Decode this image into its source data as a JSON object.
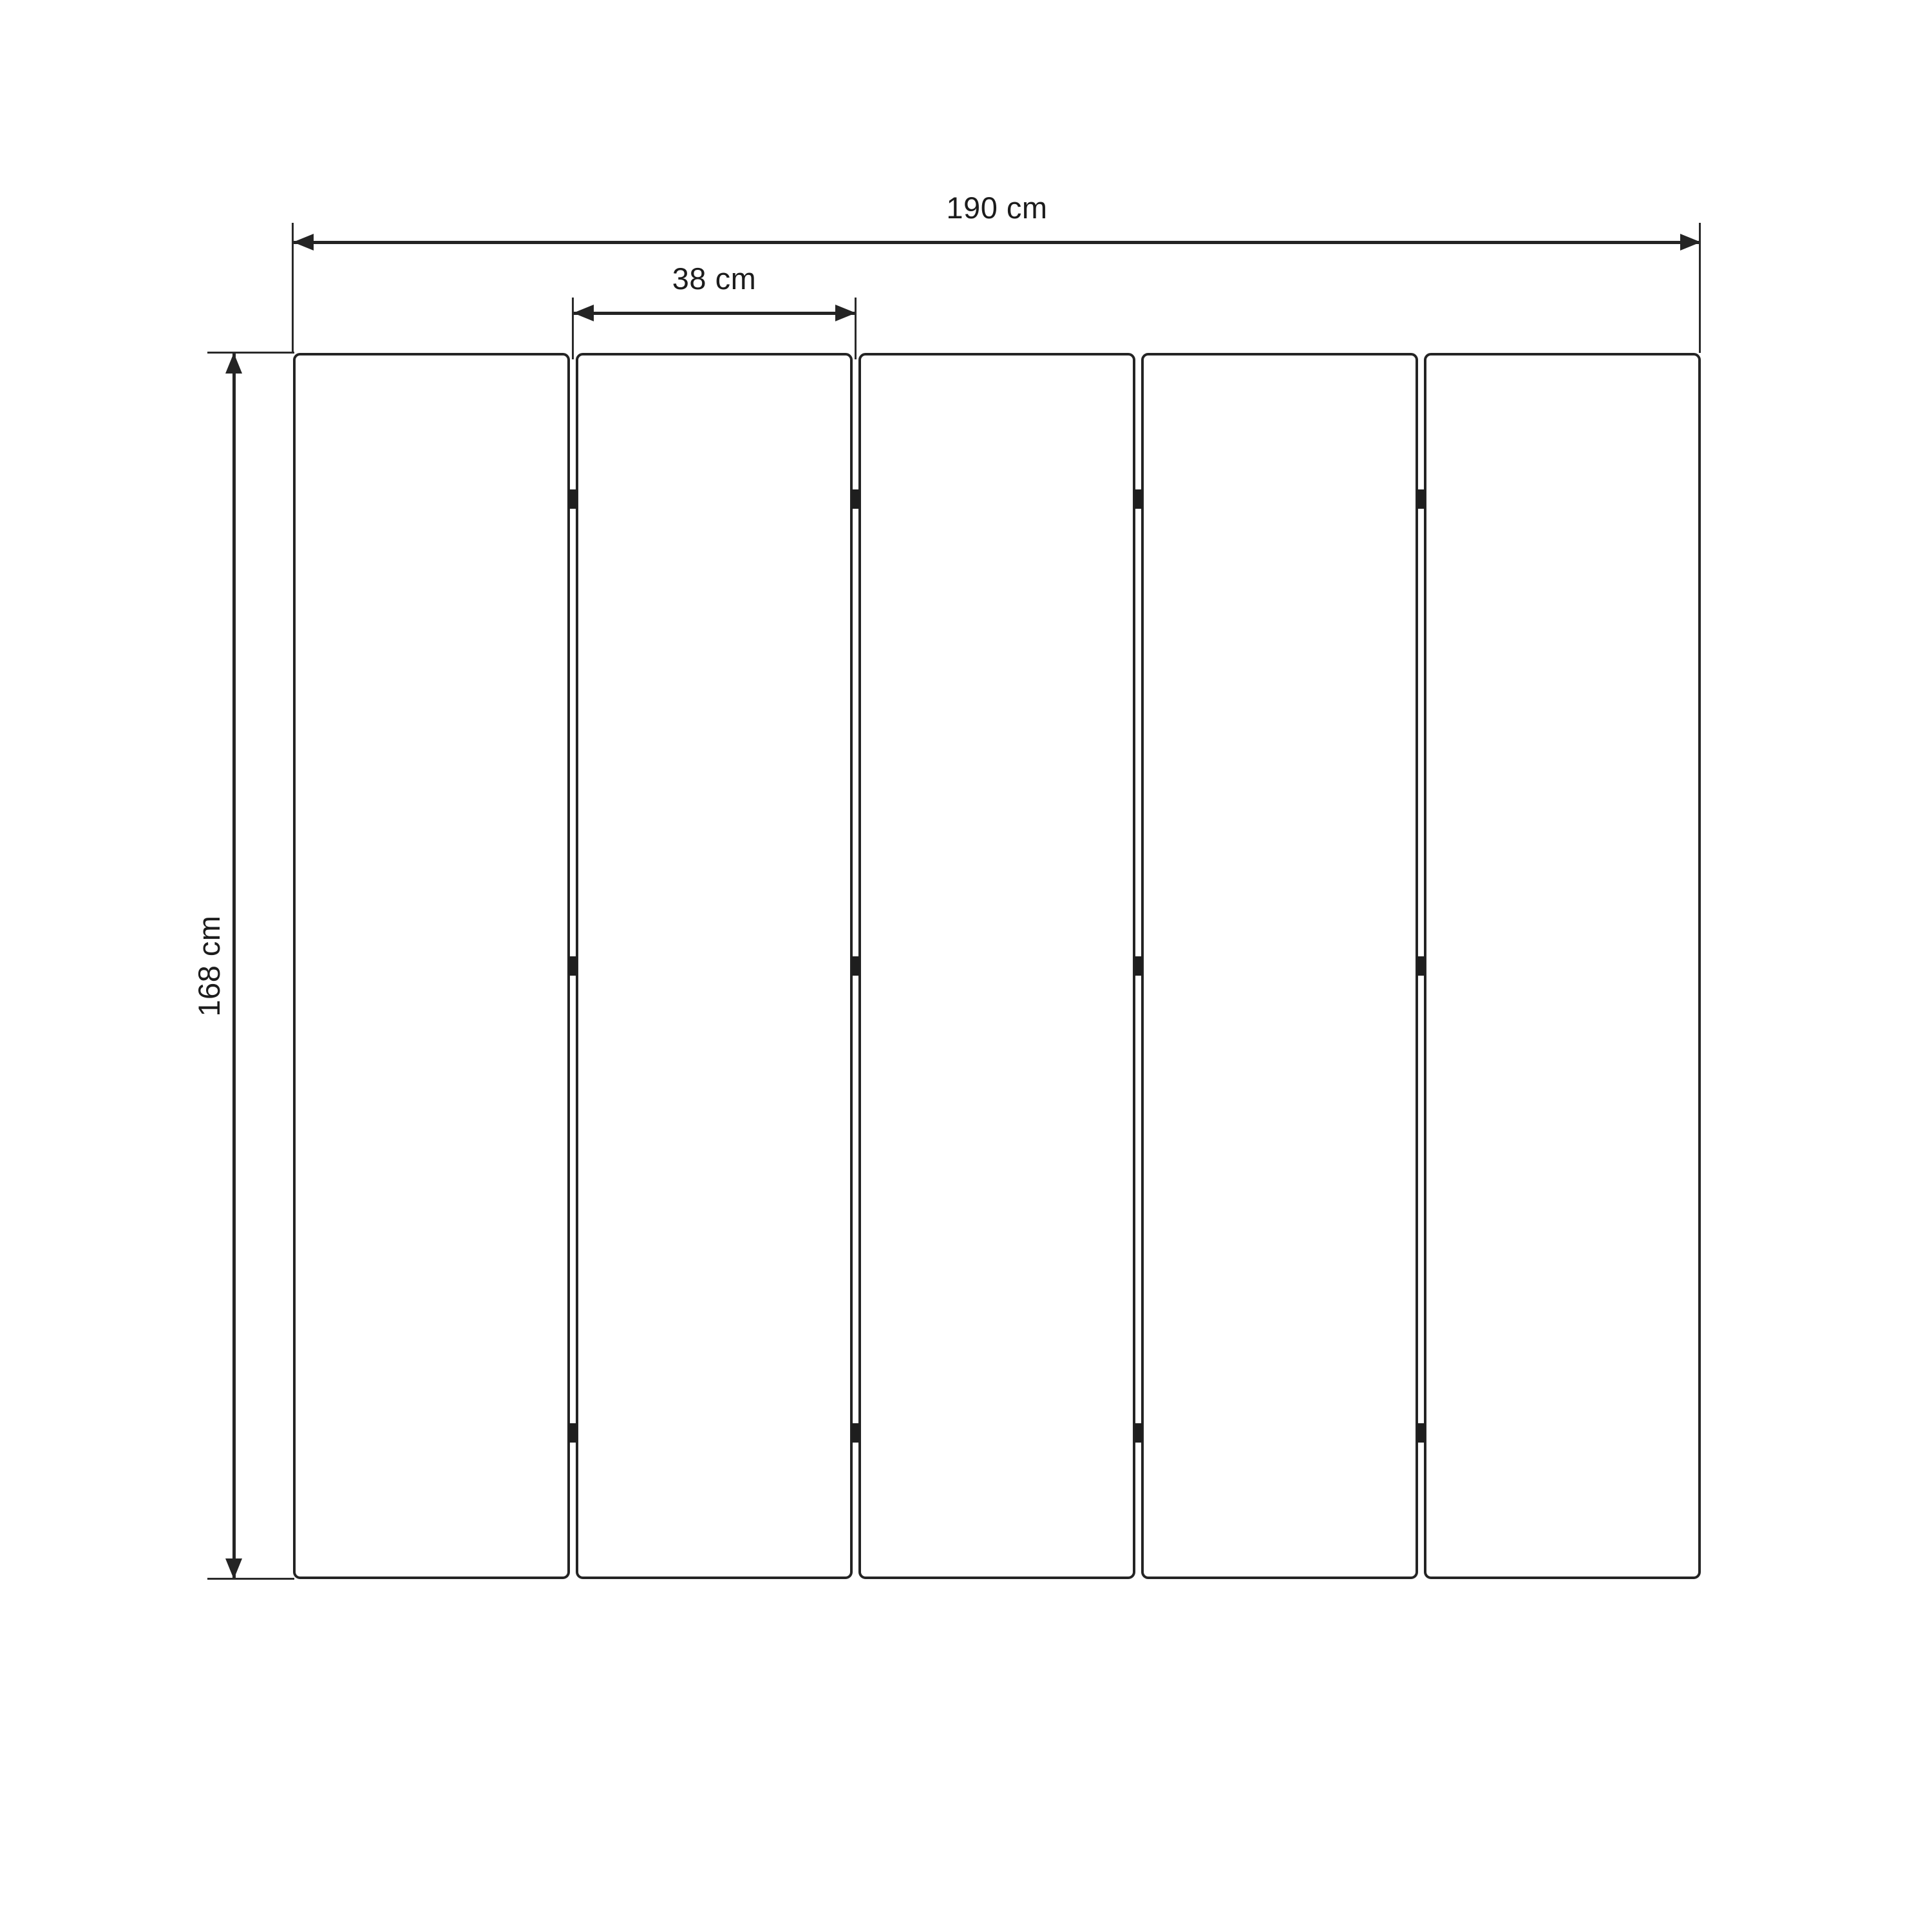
{
  "diagram": {
    "title": "folding-screen-dimension-drawing",
    "panel_count": 5,
    "hinge_gaps": 4,
    "hinge_rows_per_gap": 3,
    "dimensions": {
      "total_width": {
        "value": 190,
        "unit": "cm",
        "label": "190 cm"
      },
      "panel_width": {
        "value": 38,
        "unit": "cm",
        "label": "38 cm"
      },
      "height": {
        "value": 168,
        "unit": "cm",
        "label": "168 cm"
      }
    },
    "colors": {
      "background": "#ffffff",
      "line": "#242424",
      "text": "#1c1c1c"
    }
  }
}
